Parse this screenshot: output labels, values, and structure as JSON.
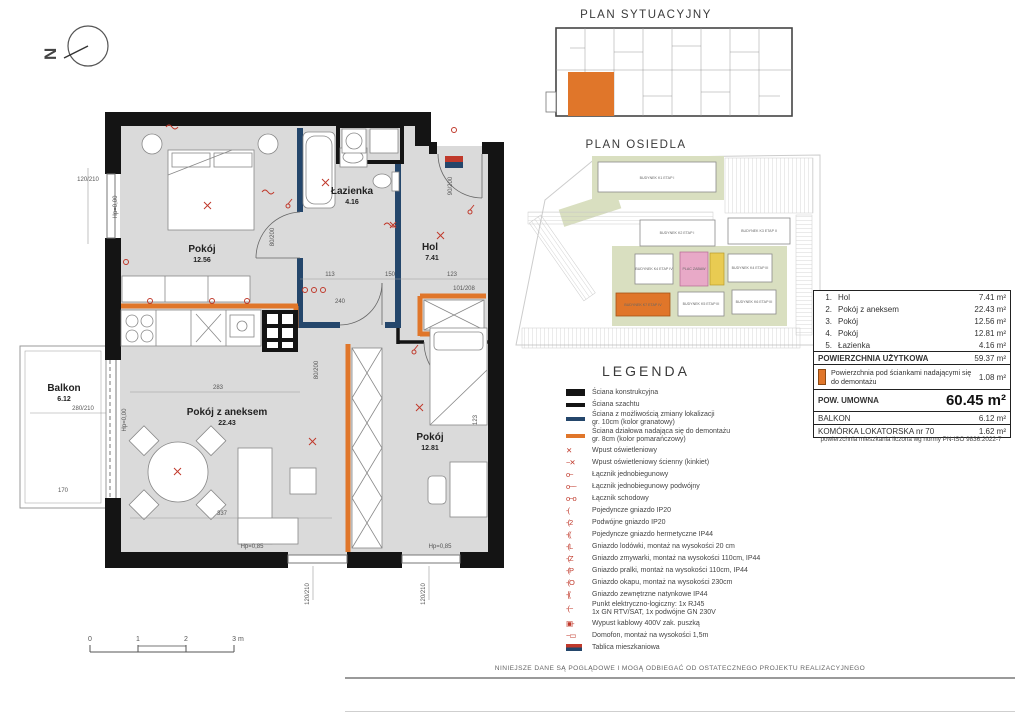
{
  "titles": {
    "plan_sytuacyjny": "PLAN SYTUACYJNY",
    "plan_osiedla": "PLAN OSIEDLA",
    "legend": "LEGENDA"
  },
  "north_label": "N",
  "floor_plan": {
    "rooms": [
      {
        "name": "Pokój",
        "area": "12.56"
      },
      {
        "name": "Łazienka",
        "area": "4.16"
      },
      {
        "name": "Hol",
        "area": "7.41"
      },
      {
        "name": "Pokój z aneksem",
        "area": "22.43"
      },
      {
        "name": "Pokój",
        "area": "12.81"
      },
      {
        "name": "Balkon",
        "area": "6.12"
      }
    ],
    "dims": [
      "120/210",
      "Hp=0,00",
      "280/210",
      "Hp=0,00",
      "170",
      "80/200",
      "80/200",
      "90/200",
      "101/208",
      "113",
      "150",
      "123",
      "123",
      "283",
      "337",
      "240",
      "120/210",
      "120/210",
      "Hp=0,85",
      "Hp=0,85"
    ]
  },
  "scale_bar": {
    "labels": [
      "0",
      "1",
      "2",
      "3 m"
    ]
  },
  "plan_osiedla": {
    "buildings": [
      {
        "label": "BUDYNEK K1 ETAP I"
      },
      {
        "label": "BUDYNEK K2 ETAP I"
      },
      {
        "label": "BUDYNEK K3 ETAP II"
      },
      {
        "label": "BUDYNEK K4 ETAP IV"
      },
      {
        "label": "BUDYNEK K4 ETAP III"
      },
      {
        "label": "BUDYNEK K7 ETAP IV"
      },
      {
        "label": "BUDYNEK K5 ETAP III"
      },
      {
        "label": "BUDYNEK K6 ETAP III"
      }
    ],
    "plac_zabaw": "PLAC ZABAW"
  },
  "area_table": {
    "rows": [
      {
        "no": "1.",
        "label": "Hol",
        "value": "7.41 m²"
      },
      {
        "no": "2.",
        "label": "Pokój z aneksem",
        "value": "22.43 m²"
      },
      {
        "no": "3.",
        "label": "Pokój",
        "value": "12.56 m²"
      },
      {
        "no": "4.",
        "label": "Pokój",
        "value": "12.81 m²"
      },
      {
        "no": "5.",
        "label": "Łazienka",
        "value": "4.16 m²"
      }
    ],
    "uzytkowa": {
      "label": "POWIERZCHNIA UŻYTKOWA",
      "value": "59.37 m²"
    },
    "demontaz": {
      "label": "Powierzchnia pod ściankami nadającymi się do demontażu",
      "value": "1.08 m²"
    },
    "umowna": {
      "label": "POW. UMOWNA",
      "value": "60.45 m²"
    },
    "balkon": {
      "label": "BALKON",
      "value": "6.12 m²"
    },
    "komorka": {
      "label": "KOMÓRKA LOKATORSKA nr 70",
      "value": "1.62 m²"
    },
    "footnote": "powierzchnia mieszkania liczona wg normy PN-ISO 9836:2022-7"
  },
  "legend": {
    "items": [
      {
        "icon": "wall-structural",
        "glyph": "",
        "label": "Ściana konstrukcyjna"
      },
      {
        "icon": "wall-shaft",
        "glyph": "",
        "label": "Ściana szachtu"
      },
      {
        "icon": "wall-navy",
        "glyph": "",
        "label": "Ściana z możliwością zmiany lokalizacji",
        "label2": "gr. 10cm (kolor granatowy)"
      },
      {
        "icon": "wall-orange",
        "glyph": "",
        "label": "Ściana działowa nadająca się do demontażu",
        "label2": "gr. 8cm (kolor pomarańczowy)"
      },
      {
        "icon": "red",
        "glyph": "✕",
        "label": "Wpust oświetleniowy"
      },
      {
        "icon": "red",
        "glyph": "~✕",
        "label": "Wpust oświetleniowy ścienny (kinkiet)"
      },
      {
        "icon": "red",
        "glyph": "o~",
        "label": "Łącznik jednobiegunowy"
      },
      {
        "icon": "red",
        "glyph": "o~~",
        "label": "Łącznik jednobiegunowy podwójny"
      },
      {
        "icon": "red",
        "glyph": "o~o",
        "label": "Łącznik schodowy"
      },
      {
        "icon": "red",
        "glyph": "-(",
        "label": "Pojedyncze gniazdo IP20"
      },
      {
        "icon": "red",
        "glyph": "-(2",
        "label": "Podwójne gniazdo IP20"
      },
      {
        "icon": "red",
        "glyph": "-((",
        "label": "Pojedyncze gniazdo hermetyczne IP44"
      },
      {
        "icon": "red",
        "glyph": "-(L",
        "label": "Gniazdo lodówki, montaż na wysokości 20 cm"
      },
      {
        "icon": "red",
        "glyph": "-(Z",
        "label": "Gniazdo zmywarki, montaż na wysokości 110cm,  IP44"
      },
      {
        "icon": "red",
        "glyph": "-(P",
        "label": "Gniazdo pralki, montaż na wysokości 110cm, IP44"
      },
      {
        "icon": "red",
        "glyph": "-(O",
        "label": "Gniazdo okapu, montaż na wysokości 230cm"
      },
      {
        "icon": "red",
        "glyph": "-[(",
        "label": "Gniazdo zewnętrzne natynkowe IP44"
      },
      {
        "icon": "red",
        "glyph": "-(~",
        "label": "Punkt elektryczno-logiczny: 1x RJ45",
        "label2": "1x GN RTV/SAT, 1x podwójne GN 230V"
      },
      {
        "icon": "red",
        "glyph": "▣-",
        "label": "Wypust kablowy 400V zak. puszką"
      },
      {
        "icon": "red",
        "glyph": "~▭",
        "label": "Domofon, montaż na wysokości 1,5m"
      },
      {
        "icon": "board",
        "glyph": "",
        "label": "Tablica mieszkaniowa"
      }
    ]
  },
  "disclaimer": "NINIEJSZE DANE SĄ POGLĄDOWE I MOGĄ ODBIEGAĆ OD OSTATECZNEGO PROJEKTU REALIZACYJNEGO",
  "colors": {
    "wall": "#141414",
    "navy": "#24466b",
    "orange": "#e0762a",
    "red_symbol": "#c0392b",
    "floor": "#dadada",
    "site_green": "#d9dfc0",
    "plac_pink": "#e8a9c7",
    "plac_yellow": "#e9cb52"
  }
}
